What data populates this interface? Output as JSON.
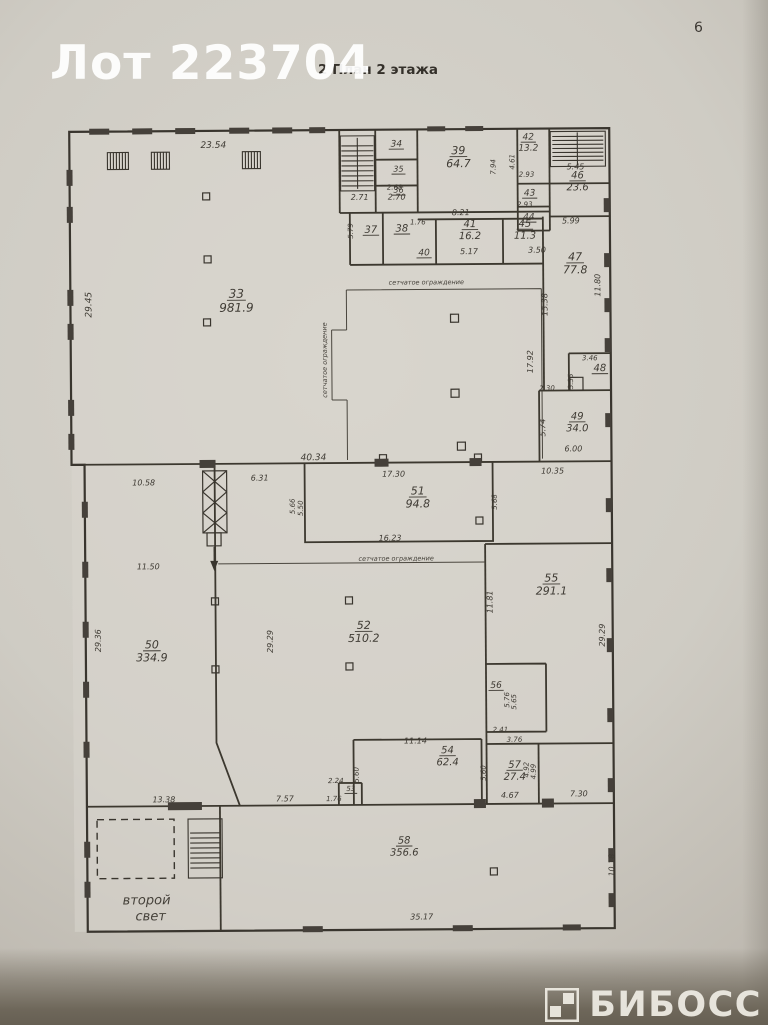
{
  "page": {
    "watermark": "Лот 223704",
    "title": "2 План 2 этажа",
    "number": "6",
    "brand": "БИБОСС",
    "ink_color": "#3c3831",
    "paper_color": "#d3d0c8"
  },
  "plan": {
    "rooms": [
      {
        "n": "33",
        "a": "981.9",
        "x": 238,
        "y": 297,
        "s": 12
      },
      {
        "n": "34",
        "a": "",
        "x": 399,
        "y": 147,
        "s": 9
      },
      {
        "n": "35",
        "a": "",
        "x": 401,
        "y": 172,
        "s": 8
      },
      {
        "n": "36",
        "a": "",
        "x": 401,
        "y": 193,
        "s": 8
      },
      {
        "n": "37",
        "a": "",
        "x": 373,
        "y": 233,
        "s": 10
      },
      {
        "n": "38",
        "a": "",
        "x": 404,
        "y": 232,
        "s": 10
      },
      {
        "n": "39",
        "a": "64.7",
        "x": 461,
        "y": 155,
        "s": 11
      },
      {
        "n": "40",
        "a": "",
        "x": 426,
        "y": 256,
        "s": 9
      },
      {
        "n": "41",
        "a": "16.2",
        "x": 472,
        "y": 228,
        "s": 10
      },
      {
        "n": "42",
        "a": "13.2",
        "x": 531,
        "y": 141,
        "s": 9
      },
      {
        "n": "43",
        "a": "",
        "x": 532,
        "y": 197,
        "s": 9
      },
      {
        "n": "44",
        "a": "",
        "x": 531,
        "y": 221,
        "s": 9
      },
      {
        "n": "45",
        "a": "11.3",
        "x": 527,
        "y": 228,
        "s": 10
      },
      {
        "n": "46",
        "a": "23.6",
        "x": 580,
        "y": 180,
        "s": 10
      },
      {
        "n": "47",
        "a": "77.8",
        "x": 577,
        "y": 262,
        "s": 11
      },
      {
        "n": "48",
        "a": "",
        "x": 601,
        "y": 373,
        "s": 10
      },
      {
        "n": "49",
        "a": "34.0",
        "x": 578,
        "y": 421,
        "s": 10
      },
      {
        "n": "50",
        "a": "334.9",
        "x": 151,
        "y": 647,
        "s": 11
      },
      {
        "n": "51",
        "a": "94.8",
        "x": 418,
        "y": 495,
        "s": 11
      },
      {
        "n": "52",
        "a": "510.2",
        "x": 363,
        "y": 629,
        "s": 11
      },
      {
        "n": "53",
        "a": "",
        "x": 349,
        "y": 791,
        "s": 7
      },
      {
        "n": "54",
        "a": "62.4",
        "x": 446,
        "y": 754,
        "s": 10
      },
      {
        "n": "55",
        "a": "291.1",
        "x": 551,
        "y": 583,
        "s": 11
      },
      {
        "n": "56",
        "a": "",
        "x": 495,
        "y": 689,
        "s": 9
      },
      {
        "n": "57",
        "a": "27.4",
        "x": 513,
        "y": 769,
        "s": 10
      },
      {
        "n": "58",
        "a": "356.6",
        "x": 402,
        "y": 844,
        "s": 10
      }
    ],
    "dims": [
      {
        "t": "23.54",
        "x": 216,
        "y": 147,
        "s": 9
      },
      {
        "t": "29.45",
        "x": 93,
        "y": 303,
        "r": -90,
        "s": 9
      },
      {
        "t": "2.71",
        "x": 362,
        "y": 200
      },
      {
        "t": "2.70",
        "x": 399,
        "y": 200
      },
      {
        "t": "2.68",
        "x": 397,
        "y": 190,
        "s": 7
      },
      {
        "t": "5.79",
        "x": 355,
        "y": 231,
        "r": -90,
        "s": 7
      },
      {
        "t": "7.94",
        "x": 498,
        "y": 168,
        "r": -90,
        "s": 7
      },
      {
        "t": "4.61",
        "x": 517,
        "y": 163,
        "r": -90,
        "s": 7
      },
      {
        "t": "2.93",
        "x": 529,
        "y": 178,
        "s": 7
      },
      {
        "t": "2.93",
        "x": 527,
        "y": 208,
        "s": 7
      },
      {
        "t": "5.45",
        "x": 578,
        "y": 171
      },
      {
        "t": "5.99",
        "x": 573,
        "y": 225
      },
      {
        "t": "8.21",
        "x": 463,
        "y": 216
      },
      {
        "t": "1.76",
        "x": 420,
        "y": 225,
        "s": 7
      },
      {
        "t": "5.17",
        "x": 471,
        "y": 255
      },
      {
        "t": "3.50",
        "x": 539,
        "y": 254
      },
      {
        "t": "11.80",
        "x": 602,
        "y": 287,
        "r": -90
      },
      {
        "t": "15.38",
        "x": 549,
        "y": 306,
        "r": -90
      },
      {
        "t": "17.92",
        "x": 534,
        "y": 363,
        "r": -90
      },
      {
        "t": "3.46",
        "x": 591,
        "y": 362,
        "s": 7
      },
      {
        "t": "3.35",
        "x": 574,
        "y": 383,
        "r": -90,
        "s": 7
      },
      {
        "t": "2.30",
        "x": 548,
        "y": 392,
        "s": 7
      },
      {
        "t": "5.74",
        "x": 546,
        "y": 429,
        "r": -90
      },
      {
        "t": "6.00",
        "x": 574,
        "y": 453
      },
      {
        "t": "40.34",
        "x": 314,
        "y": 460,
        "s": 9
      },
      {
        "t": "10.58",
        "x": 144,
        "y": 484
      },
      {
        "t": "6.31",
        "x": 260,
        "y": 480
      },
      {
        "t": "17.30",
        "x": 394,
        "y": 477
      },
      {
        "t": "10.35",
        "x": 553,
        "y": 475
      },
      {
        "t": "5.66",
        "x": 295,
        "y": 506,
        "r": -90,
        "s": 7
      },
      {
        "t": "5.50",
        "x": 303,
        "y": 508,
        "r": -90,
        "s": 7
      },
      {
        "t": "5.68",
        "x": 497,
        "y": 503,
        "r": -90,
        "s": 7
      },
      {
        "t": "16.23",
        "x": 390,
        "y": 541
      },
      {
        "t": "11.50",
        "x": 148,
        "y": 568
      },
      {
        "t": "29.36",
        "x": 100,
        "y": 639,
        "r": -90
      },
      {
        "t": "29.29",
        "x": 272,
        "y": 641,
        "r": -90
      },
      {
        "t": "11.81",
        "x": 492,
        "y": 603,
        "r": -90
      },
      {
        "t": "29.29",
        "x": 604,
        "y": 637,
        "r": -90
      },
      {
        "t": "5.76",
        "x": 508,
        "y": 701,
        "r": -90,
        "s": 7
      },
      {
        "t": "5.65",
        "x": 515,
        "y": 703,
        "r": -90,
        "s": 7
      },
      {
        "t": "2.41",
        "x": 499,
        "y": 733,
        "s": 7
      },
      {
        "t": "3.76",
        "x": 513,
        "y": 743,
        "s": 7
      },
      {
        "t": "11.14",
        "x": 414,
        "y": 744
      },
      {
        "t": "5.60",
        "x": 357,
        "y": 775,
        "r": -90,
        "s": 7
      },
      {
        "t": "5.60",
        "x": 484,
        "y": 774,
        "r": -90,
        "s": 7
      },
      {
        "t": "4.92",
        "x": 527,
        "y": 771,
        "r": -90,
        "s": 7
      },
      {
        "t": "4.99",
        "x": 534,
        "y": 773,
        "r": -90,
        "s": 7
      },
      {
        "t": "4.67",
        "x": 508,
        "y": 799
      },
      {
        "t": "2.24",
        "x": 334,
        "y": 783,
        "s": 7
      },
      {
        "t": "1.76",
        "x": 332,
        "y": 801,
        "s": 7
      },
      {
        "t": "13.38",
        "x": 162,
        "y": 801
      },
      {
        "t": "7.57",
        "x": 283,
        "y": 801
      },
      {
        "t": "7.30",
        "x": 577,
        "y": 798
      },
      {
        "t": "35.17",
        "x": 419,
        "y": 920
      },
      {
        "t": "10.18",
        "x": 612,
        "y": 867,
        "r": -90
      }
    ],
    "notes": [
      {
        "t": "сетчатое ограждение",
        "x": 428,
        "y": 285,
        "s": 6.5
      },
      {
        "t": "сетчатое ограждение",
        "x": 328,
        "y": 360,
        "r": -90,
        "s": 6.5
      },
      {
        "t": "сетчатое ограждение",
        "x": 396,
        "y": 561,
        "s": 6.5
      },
      {
        "t": "второй",
        "x": 144,
        "y": 903,
        "s": 13
      },
      {
        "t": "свет",
        "x": 148,
        "y": 919,
        "s": 13
      }
    ]
  }
}
